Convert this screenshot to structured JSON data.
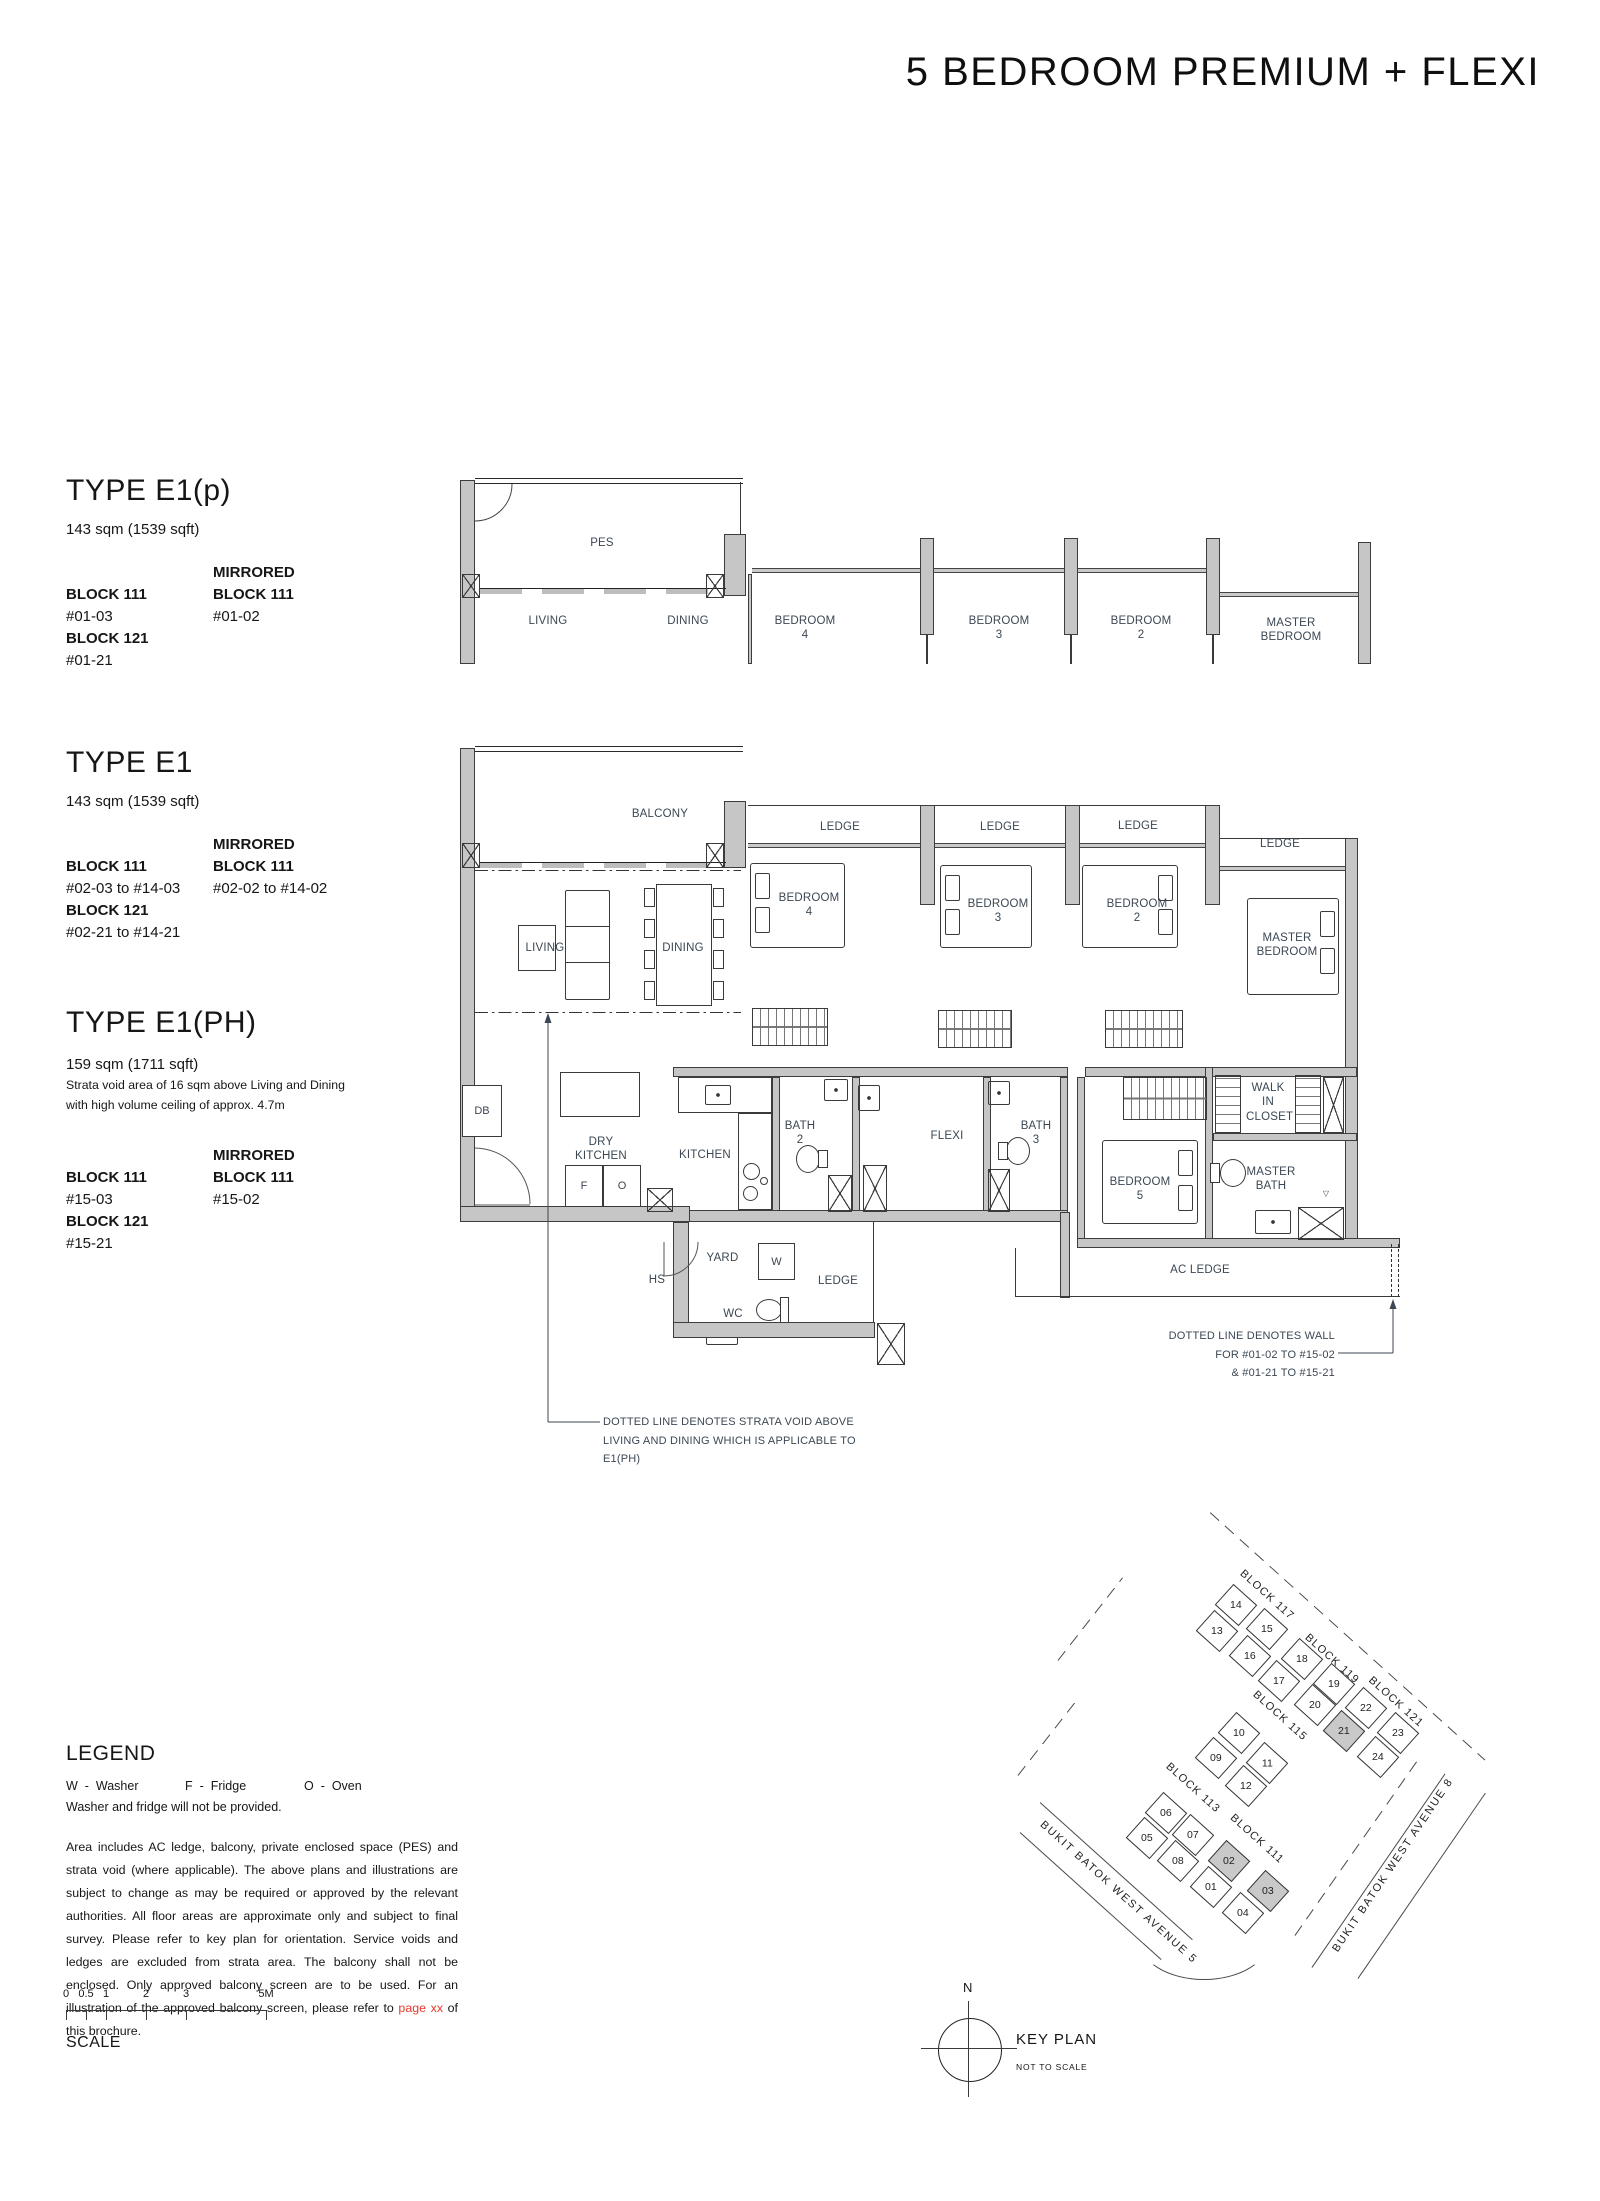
{
  "page": {
    "title": "5 BEDROOM PREMIUM + FLEXI"
  },
  "types": {
    "e1p": {
      "name": "TYPE E1(p)",
      "area": "143 sqm (1539 sqft)",
      "mirrored": "MIRRORED",
      "col1": {
        "b1": "BLOCK 111",
        "u1": "#01-03",
        "b2": "BLOCK 121",
        "u2": "#01-21"
      },
      "col2": {
        "b1": "BLOCK 111",
        "u1": "#01-02"
      }
    },
    "e1": {
      "name": "TYPE E1",
      "area": "143 sqm (1539 sqft)",
      "mirrored": "MIRRORED",
      "col1": {
        "b1": "BLOCK 111",
        "u1": "#02-03 to #14-03",
        "b2": "BLOCK 121",
        "u2": "#02-21 to #14-21"
      },
      "col2": {
        "b1": "BLOCK 111",
        "u1": "#02-02 to #14-02"
      }
    },
    "e1ph": {
      "name": "TYPE E1(PH)",
      "area": "159 sqm (1711 sqft)",
      "note1": "Strata void area of 16 sqm above Living and Dining",
      "note2": "with high volume ceiling of approx. 4.7m",
      "mirrored": "MIRRORED",
      "col1": {
        "b1": "BLOCK 111",
        "u1": "#15-03",
        "b2": "BLOCK 121",
        "u2": "#15-21"
      },
      "col2": {
        "b1": "BLOCK 111",
        "u1": "#15-02"
      }
    }
  },
  "plan_upper": {
    "labels": {
      "pes": "PES",
      "living": "LIVING",
      "dining": "DINING",
      "bedroom4": "BEDROOM 4",
      "bedroom3": "BEDROOM 3",
      "bedroom2": "BEDROOM 2",
      "master_bedroom": "MASTER BEDROOM"
    }
  },
  "plan_main": {
    "labels": {
      "balcony": "BALCONY",
      "ledge": "LEDGE",
      "living": "LIVING",
      "dining": "DINING",
      "bedroom4": "BEDROOM 4",
      "bedroom3": "BEDROOM 3",
      "bedroom2": "BEDROOM 2",
      "master_bedroom": "MASTER BEDROOM",
      "bedroom5": "BEDROOM 5",
      "db": "DB",
      "dry_kitchen": "DRY KITCHEN",
      "kitchen": "KITCHEN",
      "bath2": "BATH 2",
      "bath3": "BATH 3",
      "flexi": "FLEXI",
      "walk_in_closet": "WALK IN CLOSET",
      "master_bath": "MASTER BATH",
      "yard": "YARD",
      "wc": "WC",
      "hs": "HS",
      "w": "W",
      "f": "F",
      "o": "O",
      "ac_ledge": "AC LEDGE"
    }
  },
  "annotations": {
    "strata_void_line1": "DOTTED LINE DENOTES STRATA VOID ABOVE",
    "strata_void_line2": "LIVING AND DINING WHICH IS APPLICABLE TO E1(PH)",
    "dotted_wall_line1": "DOTTED LINE DENOTES WALL",
    "dotted_wall_line2": "FOR  #01-02 TO #15-02",
    "dotted_wall_line3": "& #01-21 TO #15-21"
  },
  "legend": {
    "title": "LEGEND",
    "items": [
      {
        "key": "W",
        "sep": "-",
        "label": "Washer"
      },
      {
        "key": "F",
        "sep": "-",
        "label": "Fridge"
      },
      {
        "key": "O",
        "sep": "-",
        "label": "Oven"
      }
    ],
    "note": "Washer and fridge will not be provided.",
    "disclaimer_pre": "Area includes AC ledge, balcony, private enclosed space (PES) and strata void (where applicable). The above plans and illustrations are subject to change as may be required or approved by the relevant authorities. All floor areas are approximate only and subject to final survey. Please refer to key plan for orientation. Service voids and ledges are excluded from strata area. The balcony shall not be enclosed. Only approved balcony screen are to be used. For an illustration of the approved balcony screen, please refer to ",
    "disclaimer_link": "page xx",
    "disclaimer_post": " of this brochure."
  },
  "scalebar": {
    "ticks": [
      "0",
      "0.5",
      "1",
      "2",
      "3",
      "5M"
    ],
    "label": "SCALE"
  },
  "keyplan": {
    "title": "KEY PLAN",
    "subtitle": "NOT TO SCALE",
    "compass_n": "N",
    "streets": {
      "avenue5": "BUKIT BATOK WEST AVENUE 5",
      "avenue8": "BUKIT BATOK WEST AVENUE 8"
    },
    "blocks": {
      "b117": "BLOCK 117",
      "b119": "BLOCK 119",
      "b121": "BLOCK 121",
      "b115": "BLOCK 115",
      "b113": "BLOCK 113",
      "b111": "BLOCK 111"
    },
    "units": {
      "u01": "01",
      "u02": "02",
      "u03": "03",
      "u04": "04",
      "u05": "05",
      "u06": "06",
      "u07": "07",
      "u08": "08",
      "u09": "09",
      "u10": "10",
      "u11": "11",
      "u12": "12",
      "u13": "13",
      "u14": "14",
      "u15": "15",
      "u16": "16",
      "u17": "17",
      "u18": "18",
      "u19": "19",
      "u20": "20",
      "u21": "21",
      "u22": "22",
      "u23": "23",
      "u24": "24"
    },
    "highlighted_units": [
      "02",
      "03",
      "21"
    ],
    "highlight_color": "#c9c9c9"
  }
}
